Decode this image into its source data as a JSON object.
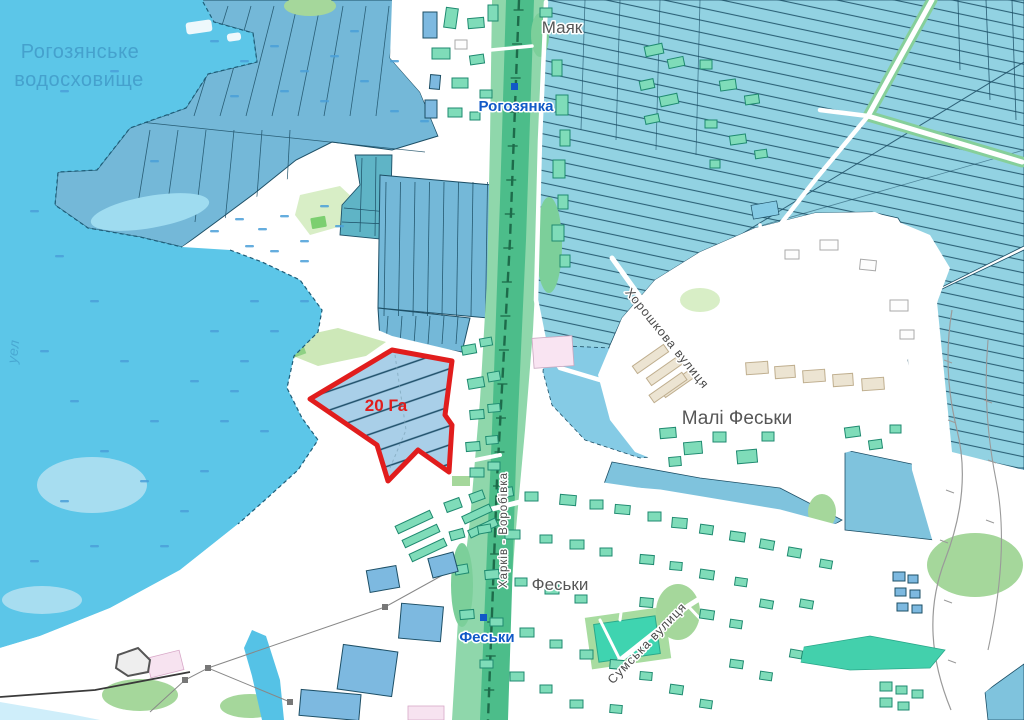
{
  "map": {
    "labels": {
      "reservoir_line1": "Рогозянське",
      "reservoir_line2": "водосховище",
      "village_top": "Маяк",
      "station_top": "Рогозянка",
      "village_right": "Малі Феськи",
      "village_bottom": "Феськи",
      "station_bottom": "Феськи",
      "street_khoroshkova": "Хорошкова вулиця",
      "street_sumska": "Сумська вулиця",
      "railway_caption": "Харків - Воробівка",
      "water_fragment": "уел",
      "parcel_area": "20 Га"
    },
    "highlighted_parcel": {
      "area_value": "20",
      "area_unit": "Га",
      "border_color": "#e11d1d"
    },
    "colors": {
      "water": "#5cc6e8",
      "field_hatch": "#92d2e2",
      "parcel_blue": "#74b8d8",
      "parcel_teal": "#5fb4c6",
      "rail_green": "#4cbd8a",
      "building_teal": "#7fdcb9",
      "building_blue": "#7db9e0",
      "vegetation_green": "#a5d79b",
      "highlight_red": "#e11d1d",
      "label_gray": "#565656",
      "station_blue": "#1159c7",
      "water_label_blue": "#45a1cd"
    }
  }
}
